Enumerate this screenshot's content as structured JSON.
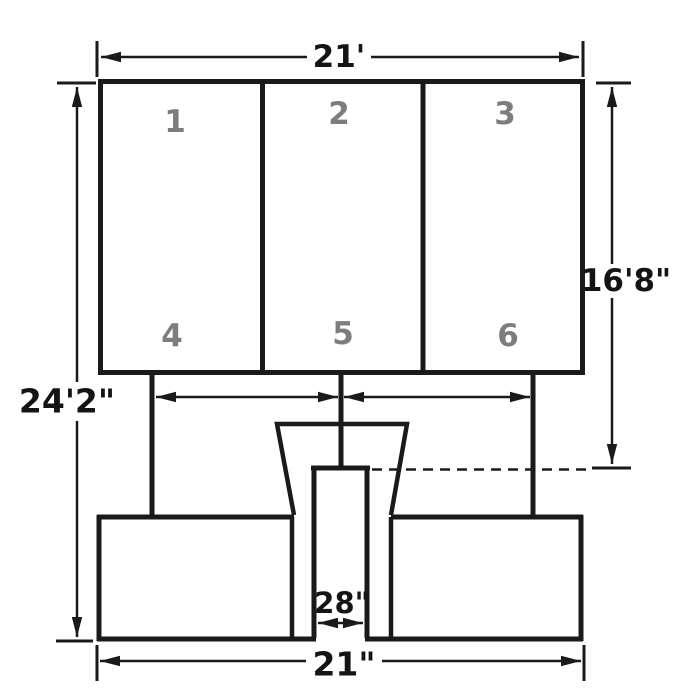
{
  "diagram": {
    "type": "sign-structure-dimension-drawing",
    "panel_numbers": [
      "1",
      "2",
      "3",
      "4",
      "5",
      "6"
    ],
    "dimensions": {
      "top_width": "21'",
      "overall_height": "24'2\"",
      "sign_face_height": "16'8\"",
      "pole_width": "28\"",
      "base_width": "21\""
    },
    "colors": {
      "line": "#1a1a1a",
      "panel_number": "#7d7d7d",
      "background": "#ffffff"
    }
  }
}
